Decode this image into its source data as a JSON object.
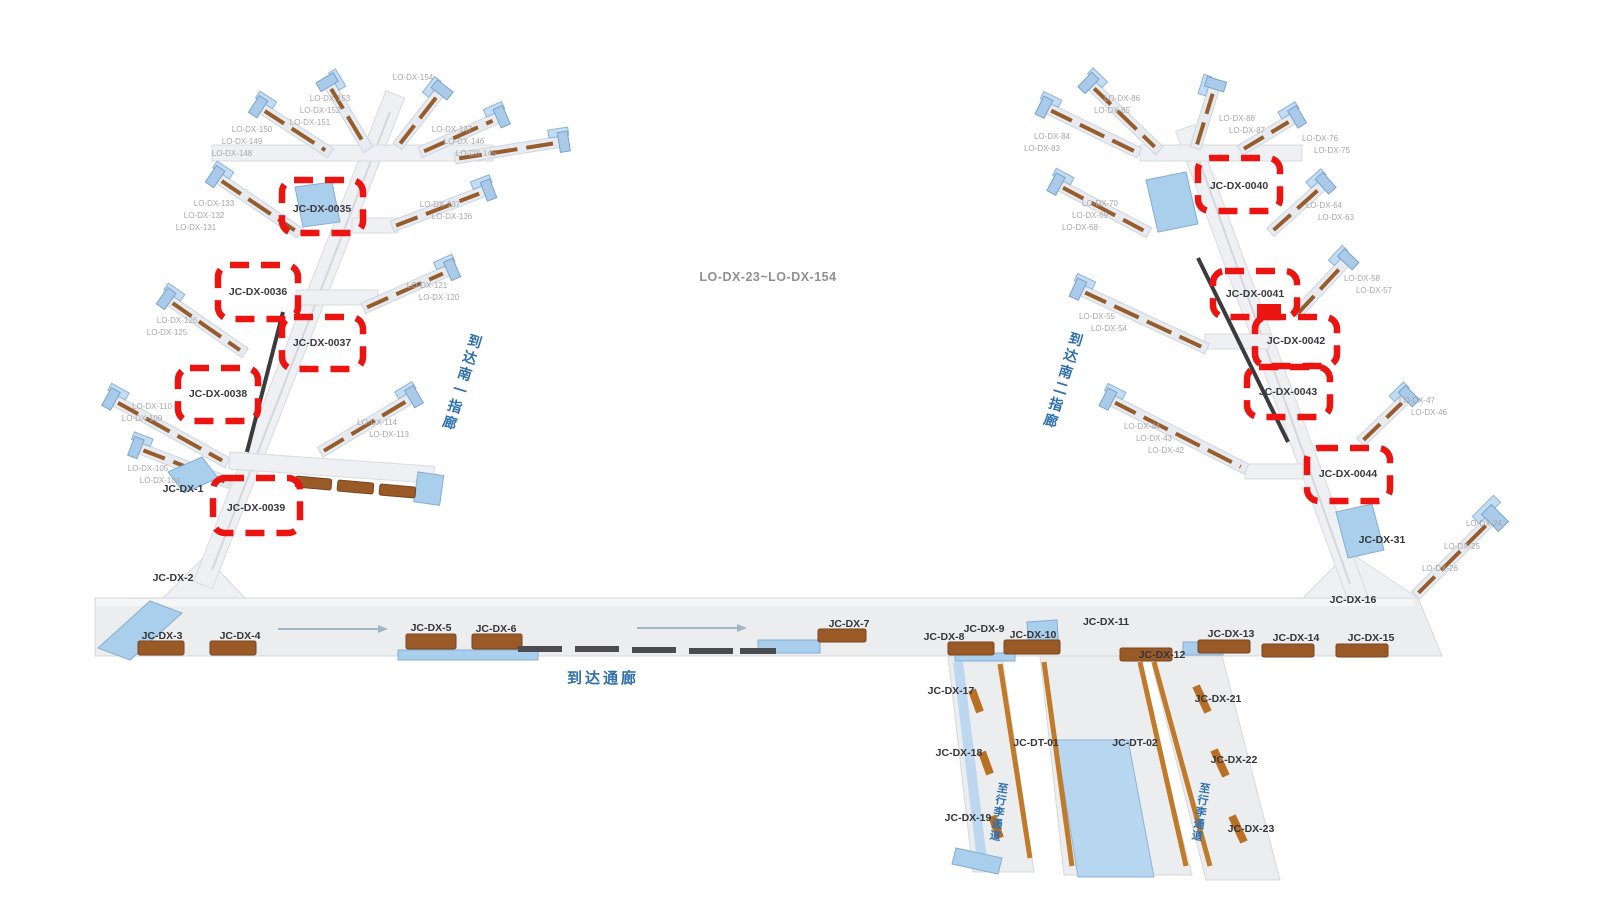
{
  "center": "LO-DX-23~LO-DX-154",
  "zh": {
    "corridor": "到达通廊",
    "pier1": "到达南一指廊",
    "pier2": "到达南二指廊",
    "bag": "至行李通道"
  },
  "box": [
    "JC-DX-0035",
    "JC-DX-0036",
    "JC-DX-0037",
    "JC-DX-0038",
    "JC-DX-0039",
    "JC-DX-0040",
    "JC-DX-0041",
    "JC-DX-0042",
    "JC-DX-0043",
    "JC-DX-0044"
  ],
  "jc": [
    "JC-DX-1",
    "JC-DX-2",
    "JC-DX-3",
    "JC-DX-4",
    "JC-DX-5",
    "JC-DX-6",
    "JC-DX-7",
    "JC-DX-8",
    "JC-DX-9",
    "JC-DX-10",
    "JC-DX-11",
    "JC-DX-12",
    "JC-DX-13",
    "JC-DX-14",
    "JC-DX-15",
    "JC-DX-16",
    "JC-DX-31",
    "JC-DX-17",
    "JC-DX-18",
    "JC-DX-19",
    "JC-DT-01",
    "JC-DT-02",
    "JC-DX-21",
    "JC-DX-22",
    "JC-DX-23"
  ],
  "sm": [
    "LO-DX-150",
    "LO-DX-149",
    "LO-DX-148",
    "LO-DX-153",
    "LO-DX-152",
    "LO-DX-151",
    "LO-DX-154",
    "LO-DX-147",
    "LO-DX-146",
    "LO-DX-145",
    "LO-DX-133",
    "LO-DX-132",
    "LO-DX-131",
    "LO-DX-137",
    "LO-DX-136",
    "LO-DX-121",
    "LO-DX-120",
    "LO-DX-126",
    "LO-DX-125",
    "LO-DX-110",
    "LO-DX-109",
    "LO-DX-105",
    "LO-DX-104",
    "LO-DX-114",
    "LO-DX-113",
    "LO-DX-84",
    "LO-DX-83",
    "LO-DX-86",
    "LO-DX-85",
    "LO-DX-88",
    "LO-DX-87",
    "LO-DX-76",
    "LO-DX-75",
    "LO-DX-70",
    "LO-DX-69",
    "LO-DX-68",
    "LO-DX-64",
    "LO-DX-63",
    "LO-DX-55",
    "LO-DX-54",
    "LO-DX-58",
    "LO-DX-57",
    "LO-DX-44",
    "LO-DX-43",
    "LO-DX-42",
    "LO-DX-47",
    "LO-DX-46",
    "LO-DX-24",
    "LO-DX-25",
    "LO-DX-26"
  ],
  "colors": {
    "highlight": "#ec1410",
    "label": "#35353a",
    "blue_text": "#2e6fad",
    "building": "#aacfec",
    "gate": "#9a5a28",
    "surface": "#ebedef"
  }
}
